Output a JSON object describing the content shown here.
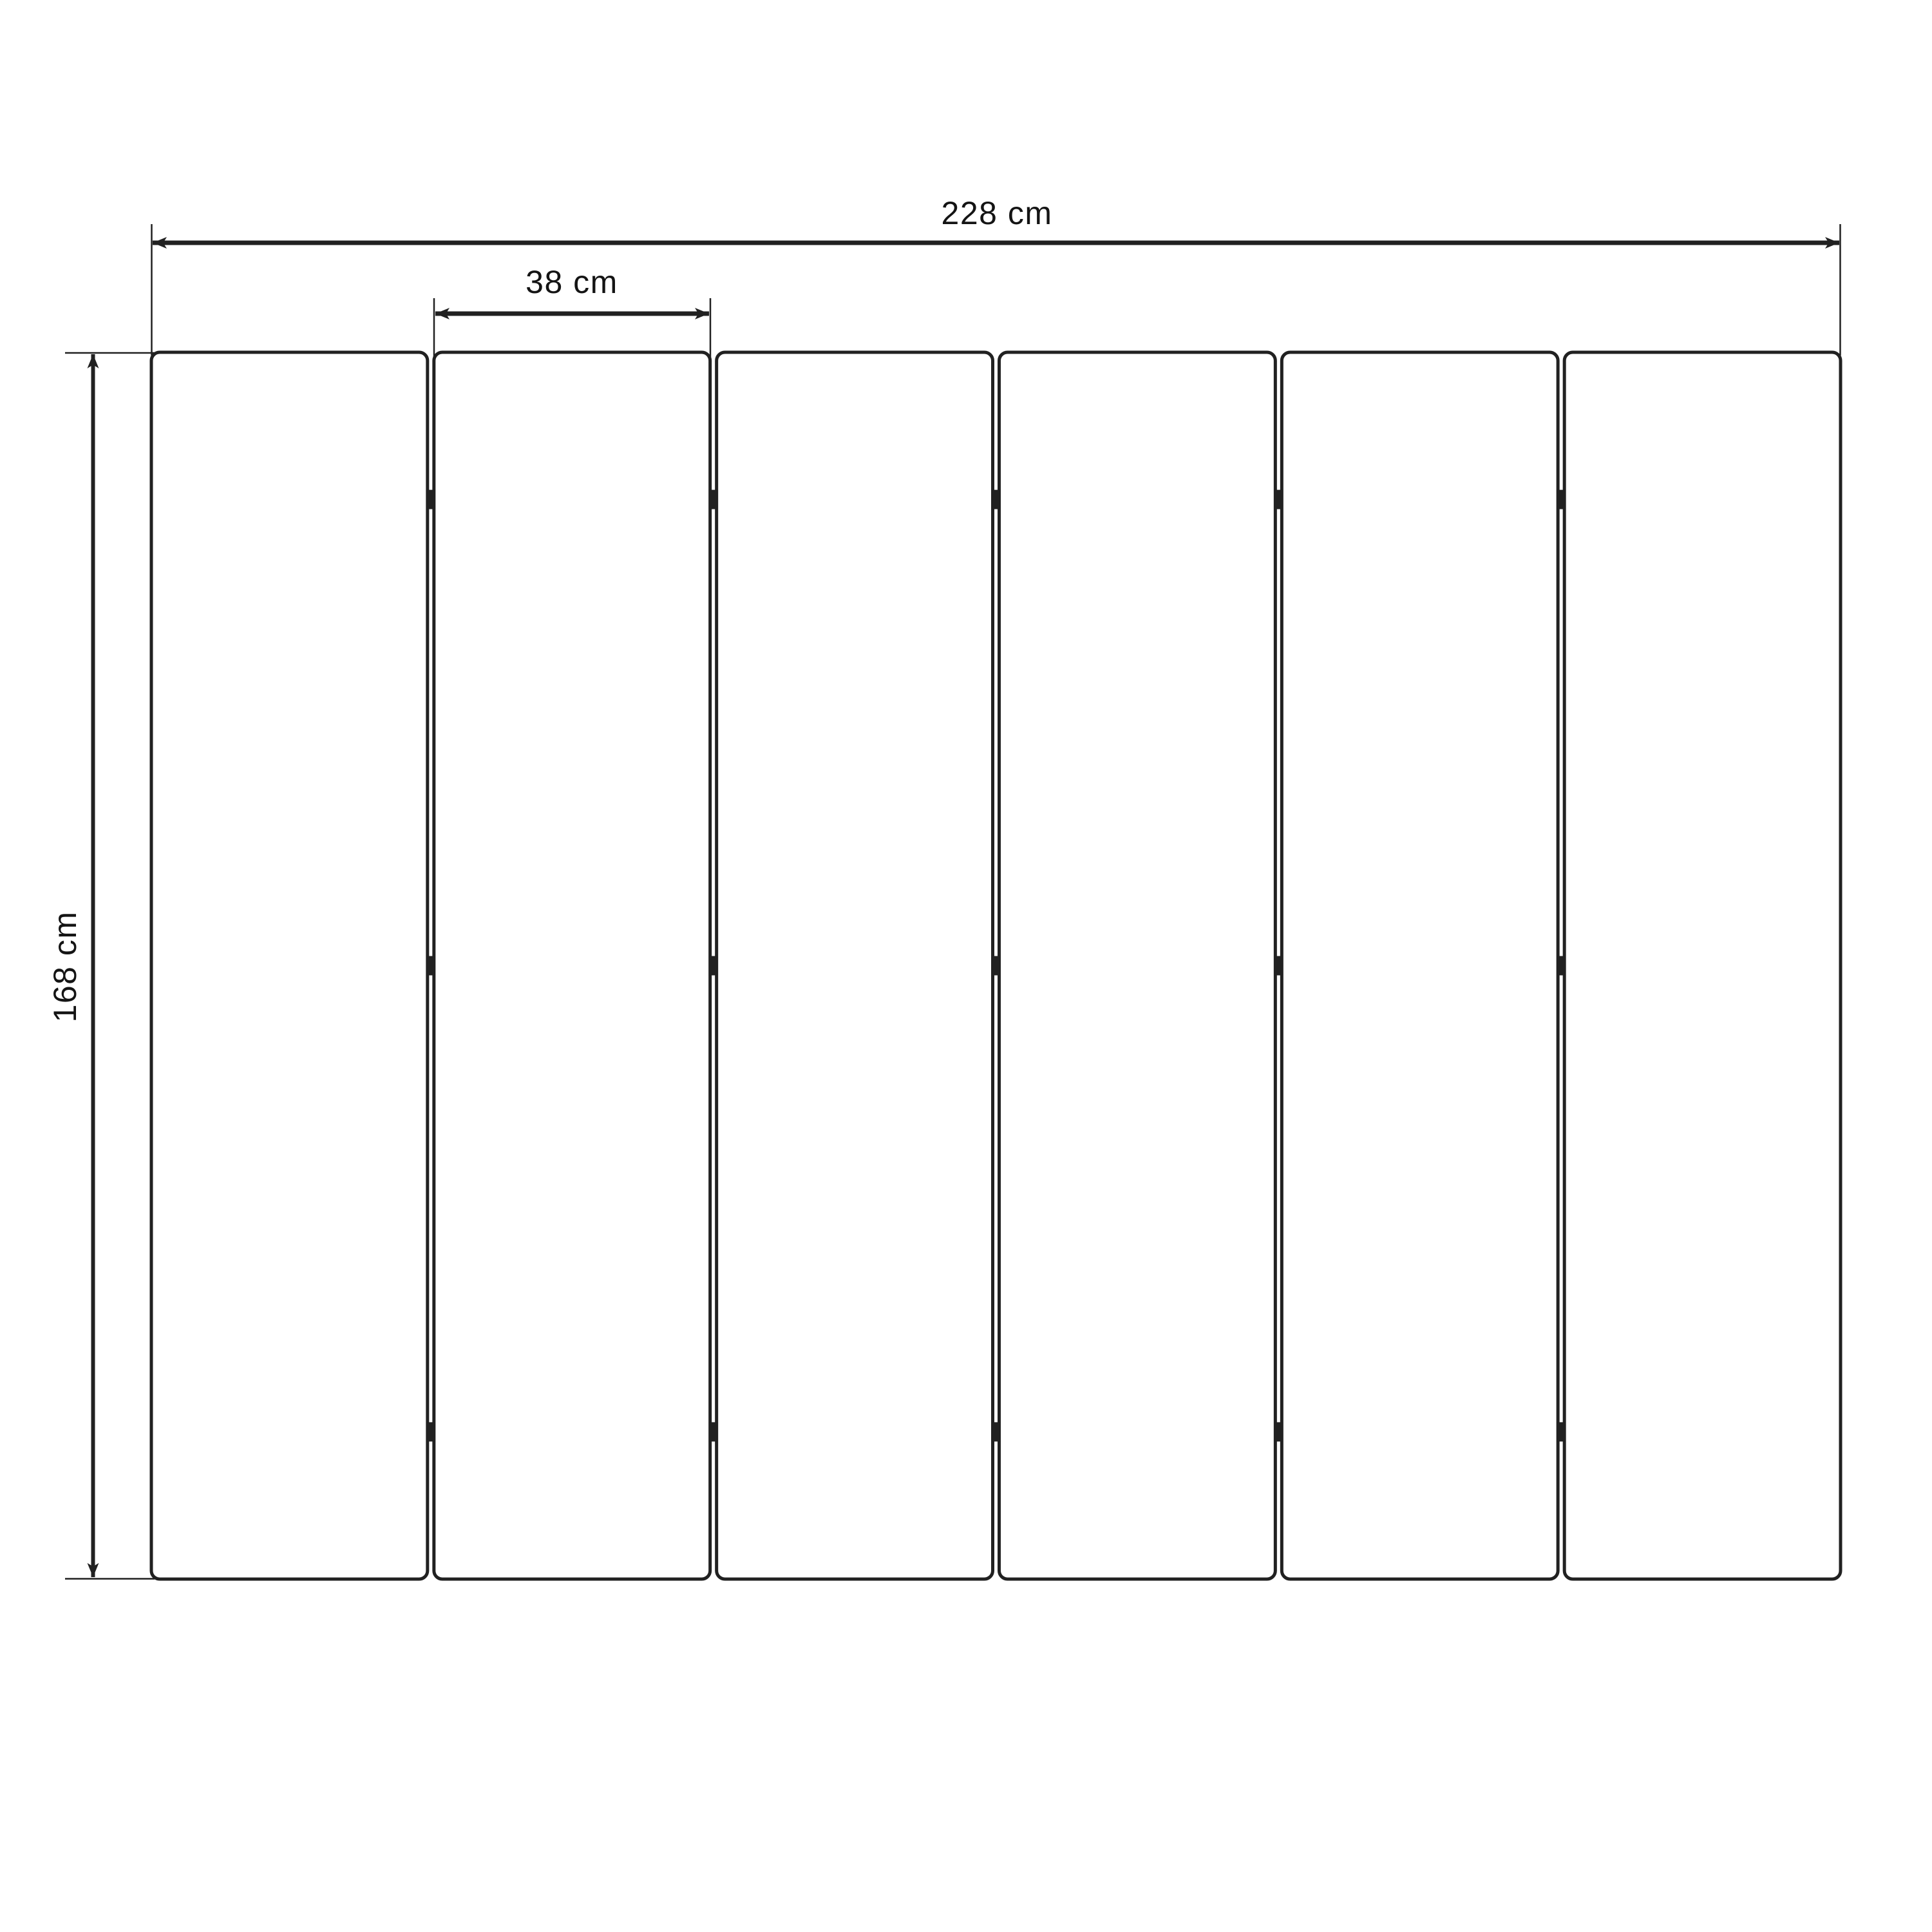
{
  "diagram": {
    "kind": "technical-dimension-drawing",
    "subject": "six-panel folding screen front view",
    "panels": {
      "count": 6,
      "hinges_per_junction": 3,
      "hinge_position_fractions": [
        0.12,
        0.5,
        0.88
      ]
    },
    "dimensions": {
      "total_width": {
        "label": "228 cm",
        "value": 228,
        "unit": "cm"
      },
      "single_panel_width": {
        "label": "38 cm",
        "value": 38,
        "unit": "cm"
      },
      "height": {
        "label": "168 cm",
        "value": 168,
        "unit": "cm"
      }
    },
    "colors": {
      "line": "#212121",
      "text": "#141414",
      "background": "#ffffff"
    }
  }
}
